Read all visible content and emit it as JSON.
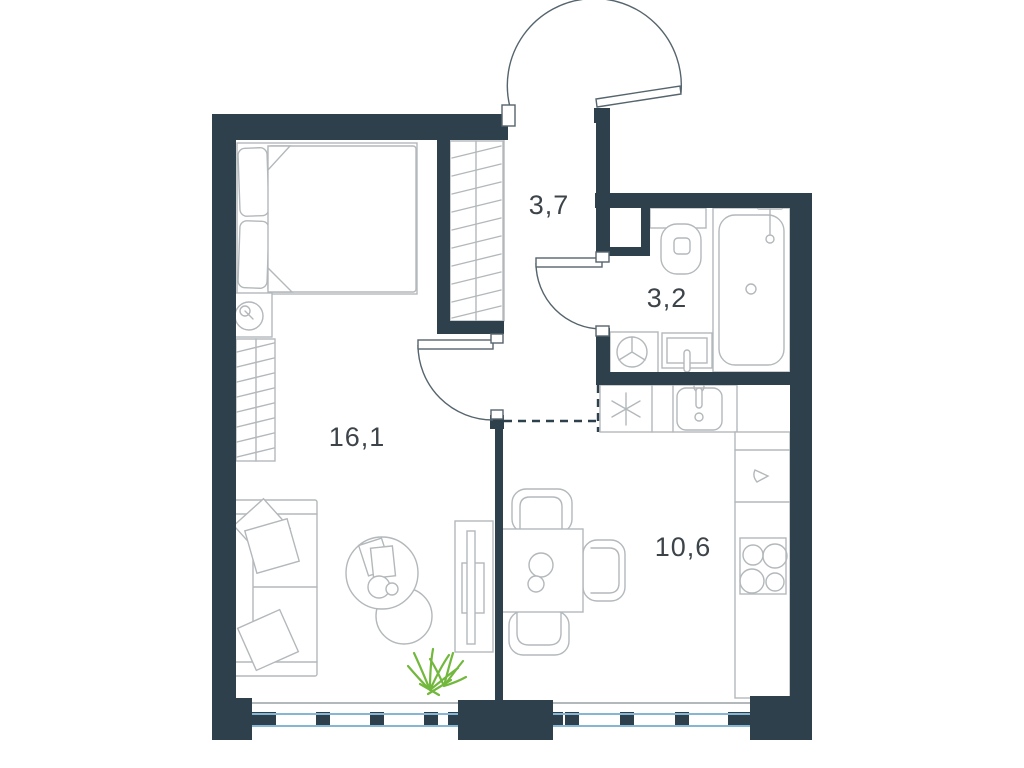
{
  "title": "apartment-floor-plan",
  "rooms": {
    "living": {
      "id": "living-room",
      "area": "16,1"
    },
    "hall": {
      "id": "hallway",
      "area": "3,7"
    },
    "bathroom": {
      "id": "bathroom",
      "area": "3,2"
    },
    "kitchen": {
      "id": "kitchen",
      "area": "10,6"
    }
  },
  "colors": {
    "wall": "#2e404b",
    "furniture": "#b3b8bb",
    "door": "#55646d",
    "glass": "#85b6d4",
    "sill": "#9aa0a3",
    "label": "#3d4449",
    "plant": "#72b83d",
    "background": "#ffffff"
  },
  "furniture_icons": [
    "double-bed",
    "bed-pillows",
    "duvet",
    "table-lamp",
    "wardrobe-hanging",
    "closet-hanging",
    "sofa",
    "sofa-cushions",
    "coffee-table",
    "side-table",
    "tv-stand",
    "potted-plant",
    "dining-table",
    "dining-chairs",
    "refrigerator-snowflake",
    "kitchen-sink",
    "hob-4-burners",
    "countertop",
    "washing-machine",
    "bathroom-sink",
    "toilet",
    "bathtub-shower"
  ],
  "doors": [
    "entrance-door",
    "bathroom-door",
    "living-room-door"
  ],
  "windows": [
    "living-room-window",
    "kitchen-window"
  ]
}
